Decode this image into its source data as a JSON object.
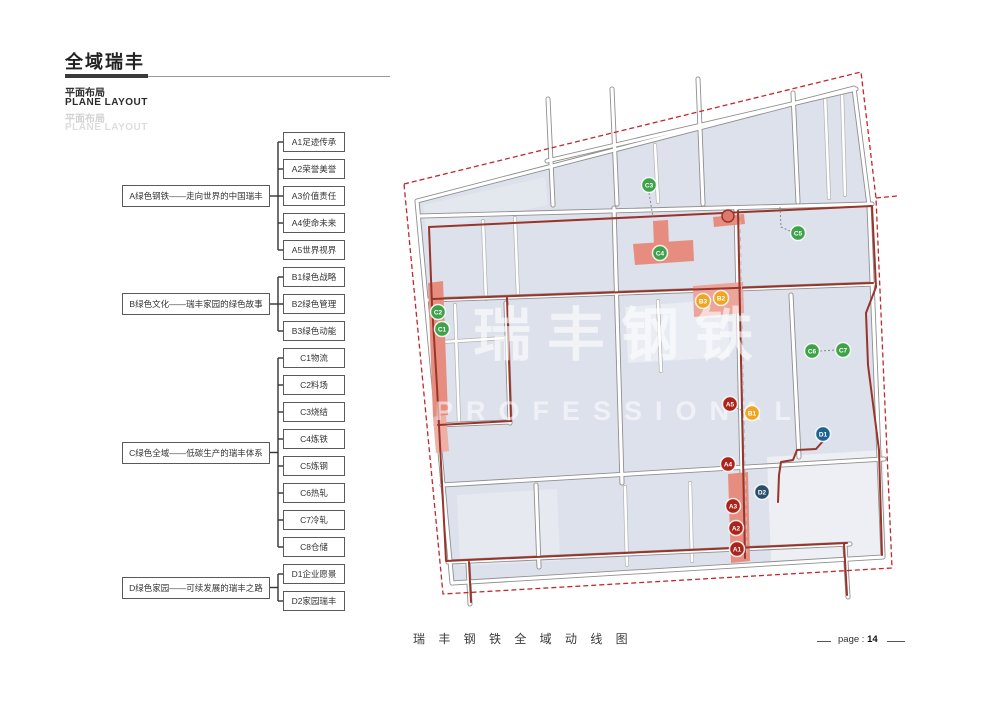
{
  "header": {
    "title": "全域瑞丰",
    "subtitle_cn": "平面布局",
    "subtitle_en": "PLANE LAYOUT",
    "subtitle_cn_faded": "平面布局",
    "subtitle_en_faded": "PLANE LAYOUT"
  },
  "tree": {
    "groups": [
      {
        "label": "A绿色钢铁——走向世界的中国瑞丰",
        "children": [
          "A1足迹传承",
          "A2荣誉美誉",
          "A3价值责任",
          "A4使命未来",
          "A5世界视界"
        ]
      },
      {
        "label": "B绿色文化——瑞丰家园的绿色故事",
        "children": [
          "B1绿色战略",
          "B2绿色管理",
          "B3绿色动能"
        ]
      },
      {
        "label": "C绿色全域——低碳生产的瑞丰体系",
        "children": [
          "C1物流",
          "C2料场",
          "C3烧结",
          "C4炼铁",
          "C5炼钢",
          "C6热轧",
          "C7冷轧",
          "C8仓储"
        ]
      },
      {
        "label": "D绿色家园——可续发展的瑞丰之路",
        "children": [
          "D1企业愿景",
          "D2家园瑞丰"
        ]
      }
    ]
  },
  "map": {
    "watermark_cn": "瑞丰钢铁",
    "watermark_en": "PROFESSIONAL",
    "colors": {
      "border": "#c1272d",
      "route": "#99342a",
      "building": "#dce1eb",
      "highlight": "#e68d80",
      "green": "#3fa24a",
      "amber": "#f0a422",
      "red": "#ab241b",
      "blue": "#1e6390",
      "navy": "#2b4f6b"
    },
    "markers": [
      {
        "id": "C3",
        "type": "green",
        "x": 254,
        "y": 130
      },
      {
        "id": "C5",
        "type": "green",
        "x": 403,
        "y": 178
      },
      {
        "id": "C4",
        "type": "green",
        "x": 265,
        "y": 198
      },
      {
        "id": "C2",
        "type": "green",
        "x": 43,
        "y": 257
      },
      {
        "id": "C1",
        "type": "green",
        "x": 47,
        "y": 274
      },
      {
        "id": "C6",
        "type": "green",
        "x": 417,
        "y": 296
      },
      {
        "id": "C7",
        "type": "green",
        "x": 448,
        "y": 295
      },
      {
        "id": "B3",
        "type": "amber",
        "x": 308,
        "y": 246
      },
      {
        "id": "B2",
        "type": "amber",
        "x": 326,
        "y": 243
      },
      {
        "id": "B1",
        "type": "amber",
        "x": 357,
        "y": 358
      },
      {
        "id": "A5",
        "type": "red",
        "x": 335,
        "y": 349
      },
      {
        "id": "A4",
        "type": "red",
        "x": 333,
        "y": 409
      },
      {
        "id": "A3",
        "type": "red",
        "x": 338,
        "y": 451
      },
      {
        "id": "A2",
        "type": "red",
        "x": 341,
        "y": 473
      },
      {
        "id": "A1",
        "type": "red",
        "x": 342,
        "y": 494
      },
      {
        "id": "D1",
        "type": "blue",
        "x": 428,
        "y": 379
      },
      {
        "id": "D2",
        "type": "navy",
        "x": 367,
        "y": 437
      }
    ]
  },
  "footer": {
    "caption": "瑞 丰 钢 铁 全 域 动 线 图",
    "page_label": "page :",
    "page_number": "14"
  }
}
